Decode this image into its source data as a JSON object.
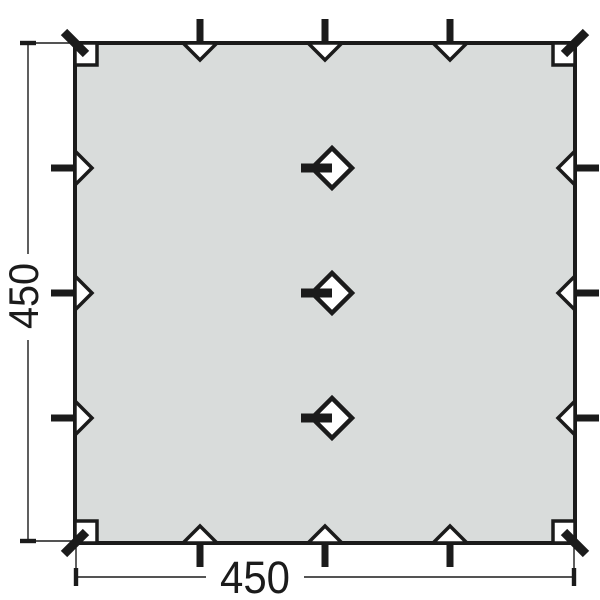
{
  "diagram": {
    "labels": {
      "width": "450",
      "height": "450"
    },
    "colors": {
      "fabric": "#d9dcdb",
      "outline": "#1b1b1b",
      "background": "#ffffff"
    },
    "features": {
      "edge_guy_loops_per_side": 3,
      "peg_markers_per_side": 3,
      "corner_straps": 4,
      "corner_pockets": 4,
      "center_hang_loops": 3,
      "center_toggles": 3
    }
  }
}
